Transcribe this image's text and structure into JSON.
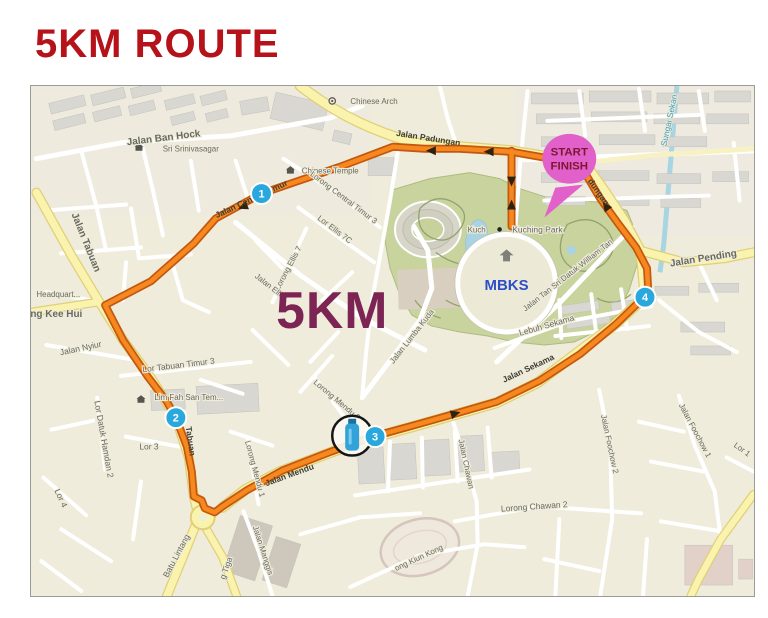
{
  "header": {
    "title": "5KM ROUTE",
    "title_color": "#B5121A"
  },
  "map": {
    "distance_label": "5KM",
    "start_finish": {
      "line1": "START",
      "line2": "FINISH",
      "balloon_color": "#E160C9",
      "text_color": "#7E1533"
    },
    "markers": [
      {
        "label": "1"
      },
      {
        "label": "2"
      },
      {
        "label": "3"
      },
      {
        "label": "4"
      }
    ],
    "marker_color": "#29A8DE",
    "water_station": {
      "icon": "water-bottle"
    },
    "route_color": "#F6881F",
    "route_casing_color": "#C2570F",
    "park_color": "#C8D39D",
    "road_yellow": "#FAF3AE",
    "river_color": "#A9D4E2",
    "labels": [
      {
        "text": "Jalan Ban Hock"
      },
      {
        "text": "Sri Srinivasagar"
      },
      {
        "text": "Chinese Arch"
      },
      {
        "text": "Jalan Padungan"
      },
      {
        "text": "Chinese Temple"
      },
      {
        "text": "Lorong Central Timur 3"
      },
      {
        "text": "Lor Ellis 7C"
      },
      {
        "text": "Lorong Ellis 7"
      },
      {
        "text": "Jalan Central Timur"
      },
      {
        "text": "Jalan Tabuan"
      },
      {
        "text": "Headquart..."
      },
      {
        "text": "ng Kee Hui"
      },
      {
        "text": "Jalan Nyiur"
      },
      {
        "text": "Lor Tabuan Timur 3"
      },
      {
        "text": "Lim Fah San Tem..."
      },
      {
        "text": "Lor Datuk Hamdan 2"
      },
      {
        "text": "Lor 3"
      },
      {
        "text": "Lor 4"
      },
      {
        "text": "Tabuan"
      },
      {
        "text": "Batu Lintang"
      },
      {
        "text": "g Tiga"
      },
      {
        "text": "Jalan Manggis"
      },
      {
        "text": "Lorong Mendu 3"
      },
      {
        "text": "Lorong Mendu 1"
      },
      {
        "text": "Jalan Mendu"
      },
      {
        "text": "Jalan Chawan"
      },
      {
        "text": "Lorong Chawan 2"
      },
      {
        "text": "Jalan Foochow 2"
      },
      {
        "text": "Jalan Foochow 1"
      },
      {
        "text": "Lor 1"
      },
      {
        "text": "ong Kiun Kong"
      },
      {
        "text": "Jalan Lumba Kuda"
      },
      {
        "text": "Jalan Ellis"
      },
      {
        "text": "Jalan Tan Sri Datuk William Tan"
      },
      {
        "text": "Lebuh Sekama"
      },
      {
        "text": "Jalan Sekama"
      },
      {
        "text": "Jalan Pending"
      },
      {
        "text": "Sungai Sekan"
      },
      {
        "text": "Kuching Park"
      },
      {
        "text": "dungan"
      },
      {
        "text": "MBKS"
      },
      {
        "text": "Kuch"
      }
    ]
  }
}
